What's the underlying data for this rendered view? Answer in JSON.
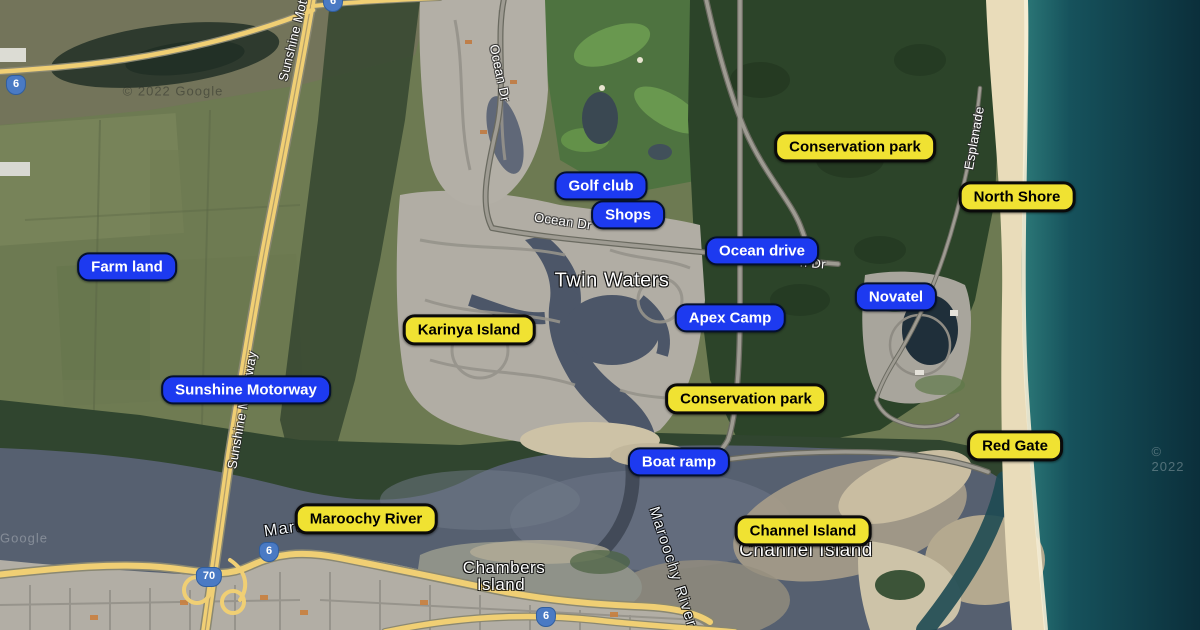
{
  "map": {
    "colors": {
      "annotation_blue": "#1d3af0",
      "annotation_yellow": "#f0e232",
      "route_shield_blue": "#4a7ac4",
      "ocean_deep": "#0b2f3b",
      "ocean_shore": "#8fd8c3",
      "river": "#566070",
      "beach_sand": "#e9dcba"
    },
    "annotations": [
      {
        "label": "Golf club",
        "type": "blue",
        "x": 601,
        "y": 186
      },
      {
        "label": "Shops",
        "type": "blue",
        "x": 628,
        "y": 215
      },
      {
        "label": "Ocean drive",
        "type": "blue",
        "x": 762,
        "y": 251
      },
      {
        "label": "Apex Camp",
        "type": "blue",
        "x": 730,
        "y": 318
      },
      {
        "label": "Novatel",
        "type": "blue",
        "x": 896,
        "y": 297
      },
      {
        "label": "Farm land",
        "type": "blue",
        "x": 127,
        "y": 267
      },
      {
        "label": "Sunshine Motorway",
        "type": "blue",
        "x": 246,
        "y": 390
      },
      {
        "label": "Boat ramp",
        "type": "blue",
        "x": 679,
        "y": 462
      },
      {
        "label": "Conservation park",
        "type": "yellow",
        "x": 855,
        "y": 147
      },
      {
        "label": "North Shore",
        "type": "yellow",
        "x": 1017,
        "y": 197
      },
      {
        "label": "Karinya Island",
        "type": "yellow",
        "x": 469,
        "y": 330
      },
      {
        "label": "Conservation park",
        "type": "yellow",
        "x": 746,
        "y": 399
      },
      {
        "label": "Red Gate",
        "type": "yellow",
        "x": 1015,
        "y": 446
      },
      {
        "label": "Maroochy River",
        "type": "yellow",
        "x": 366,
        "y": 519
      },
      {
        "label": "Channel Island",
        "type": "yellow",
        "x": 803,
        "y": 531
      }
    ],
    "place_labels": [
      {
        "text": "Twin Waters",
        "x": 612,
        "y": 281,
        "size": 20
      },
      {
        "text": "Chambers",
        "x": 504,
        "y": 568,
        "size": 17
      },
      {
        "text": "Island",
        "x": 501,
        "y": 585,
        "size": 17
      },
      {
        "text": "Channel Island",
        "x": 806,
        "y": 551,
        "size": 19
      }
    ],
    "road_labels": [
      {
        "text": "Ocean Dr",
        "x": 500,
        "y": 73,
        "rotate": 78
      },
      {
        "text": "Ocean Dr",
        "x": 563,
        "y": 221,
        "rotate": 8
      },
      {
        "text": "n Dr",
        "x": 813,
        "y": 263,
        "rotate": 5
      },
      {
        "text": "Esplanade",
        "x": 974,
        "y": 138,
        "rotate": -80
      },
      {
        "text": "Sunshine Motorway",
        "x": 297,
        "y": 23,
        "rotate": -76
      },
      {
        "text": "Sunshine Motorway",
        "x": 242,
        "y": 410,
        "rotate": -80
      }
    ],
    "water_labels": [
      {
        "text": "Maroochy River",
        "x": 330,
        "y": 523,
        "rotate": -8,
        "size": 16,
        "faint": false
      },
      {
        "text": "Maroochy River",
        "x": 673,
        "y": 567,
        "rotate": 72,
        "size": 15,
        "faint": false
      },
      {
        "text": "Ocean",
        "x": 790,
        "y": 259,
        "rotate": 0,
        "size": 16,
        "faint": true
      }
    ],
    "route_shields": [
      {
        "number": "6",
        "x": 16,
        "y": 85
      },
      {
        "number": "6",
        "x": 333,
        "y": 2
      },
      {
        "number": "70",
        "x": 209,
        "y": 577
      },
      {
        "number": "6",
        "x": 269,
        "y": 552
      },
      {
        "number": "6",
        "x": 546,
        "y": 617
      }
    ],
    "watermarks": [
      {
        "text": "© 2022 Google",
        "x": 173,
        "y": 91,
        "tone": "dark"
      },
      {
        "text": "Google",
        "x": 24,
        "y": 538,
        "tone": "light"
      },
      {
        "text": "© 2022",
        "x": 1168,
        "y": 459,
        "tone": "light"
      }
    ]
  }
}
